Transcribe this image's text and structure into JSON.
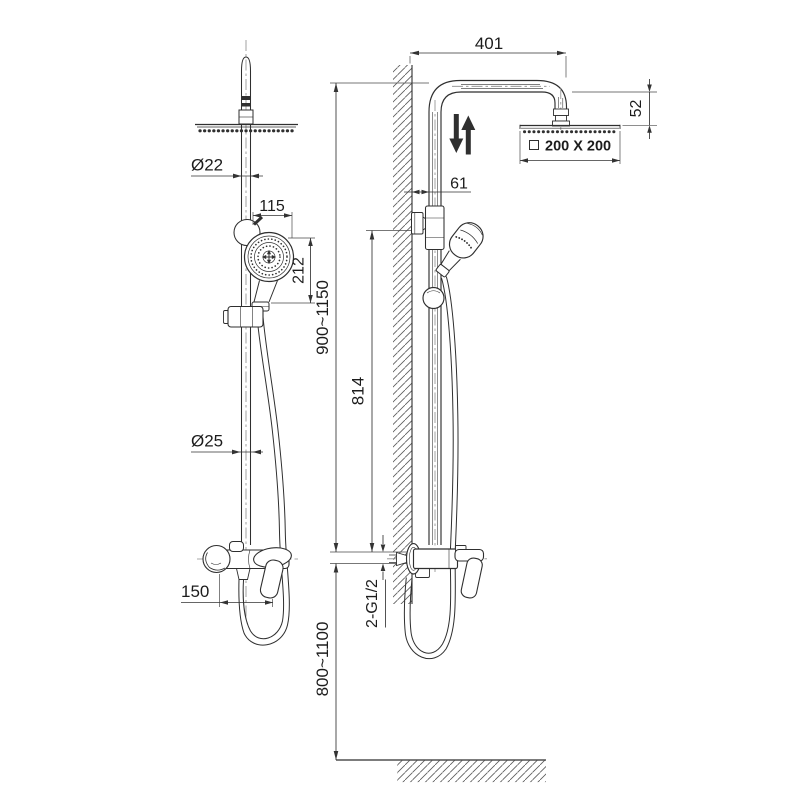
{
  "colors": {
    "ink": "#2f2f2f",
    "text": "#1c1c1c",
    "background": "#ffffff"
  },
  "front_view": {
    "dim_top_pipe_diameter": "Ø22",
    "dim_hand_shower_width": "115",
    "dim_hand_shower_height": "212",
    "dim_lower_pipe_diameter": "Ø25",
    "dim_outlet_spacing": "150"
  },
  "side_view": {
    "dim_arm_reach": "401",
    "dim_head_drop": "52",
    "dim_head_size": "200 X 200",
    "dim_wall_to_pipe": "61",
    "dim_riser_range": "900~1150",
    "dim_bracket_to_valve": "814",
    "label_inlet_threads": "2-G1/2",
    "dim_valve_to_floor": "800~1100"
  }
}
